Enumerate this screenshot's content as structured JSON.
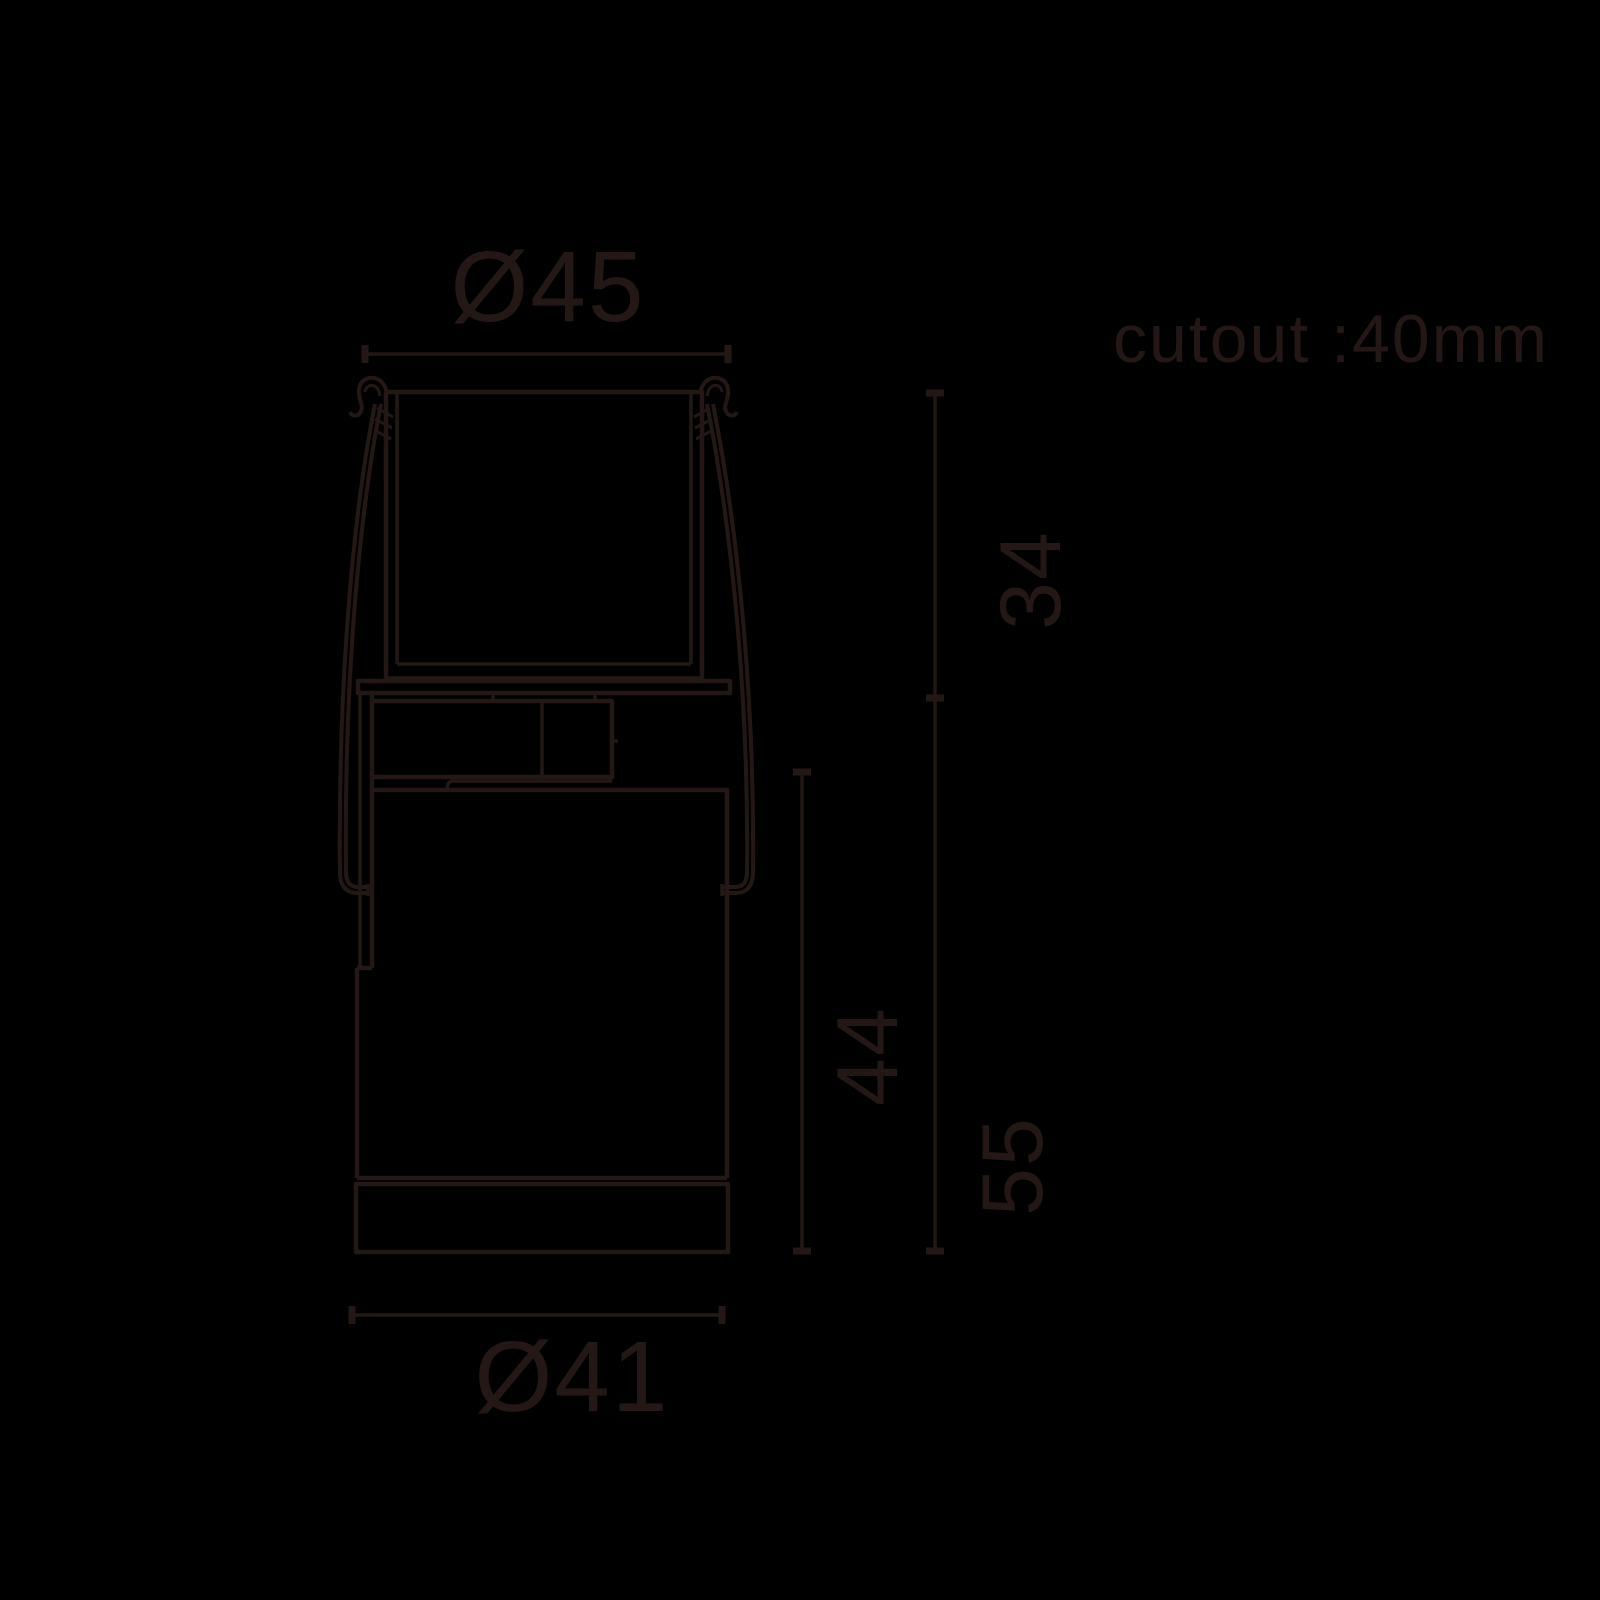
{
  "page": {
    "background_color": "#000000",
    "line_color": "#231815"
  },
  "dimensions": {
    "top_diameter": "Ø45",
    "cutout_note": "cutout :40mm",
    "upper_height": "34",
    "body_height": "44",
    "overall_height": "55",
    "bottom_diameter": "Ø41"
  }
}
